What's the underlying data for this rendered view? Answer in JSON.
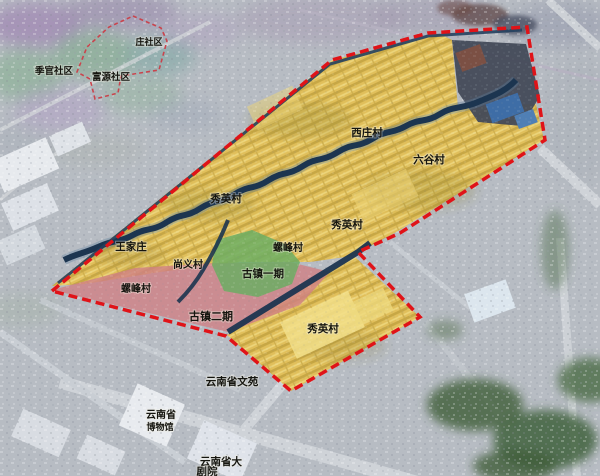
{
  "map": {
    "colors": {
      "background_gray": "#b7bcc3",
      "boundary_red": "#e01318",
      "boundary_red_light": "#c9444d",
      "zone_yellow": "#e2bf55",
      "zone_green": "#6cae63",
      "zone_pink": "#cf7f84",
      "river_navy": "#1c3550"
    },
    "labels": [
      {
        "text": "庄社区"
      },
      {
        "text": "季官社区"
      },
      {
        "text": "富源社区"
      },
      {
        "text": "西庄村"
      },
      {
        "text": "六谷村"
      },
      {
        "text": "秀英村"
      },
      {
        "text": "秀英村"
      },
      {
        "text": "螺峰村"
      },
      {
        "text": "王家庄"
      },
      {
        "text": "尚义村"
      },
      {
        "text": "古镇一期"
      },
      {
        "text": "螺峰村"
      },
      {
        "text": "古镇二期"
      },
      {
        "text": "秀英村"
      },
      {
        "text": "云南省文苑"
      },
      {
        "text": "云南省"
      },
      {
        "text": "博物馆"
      },
      {
        "text": "云南省大"
      },
      {
        "text": "剧院"
      }
    ]
  }
}
